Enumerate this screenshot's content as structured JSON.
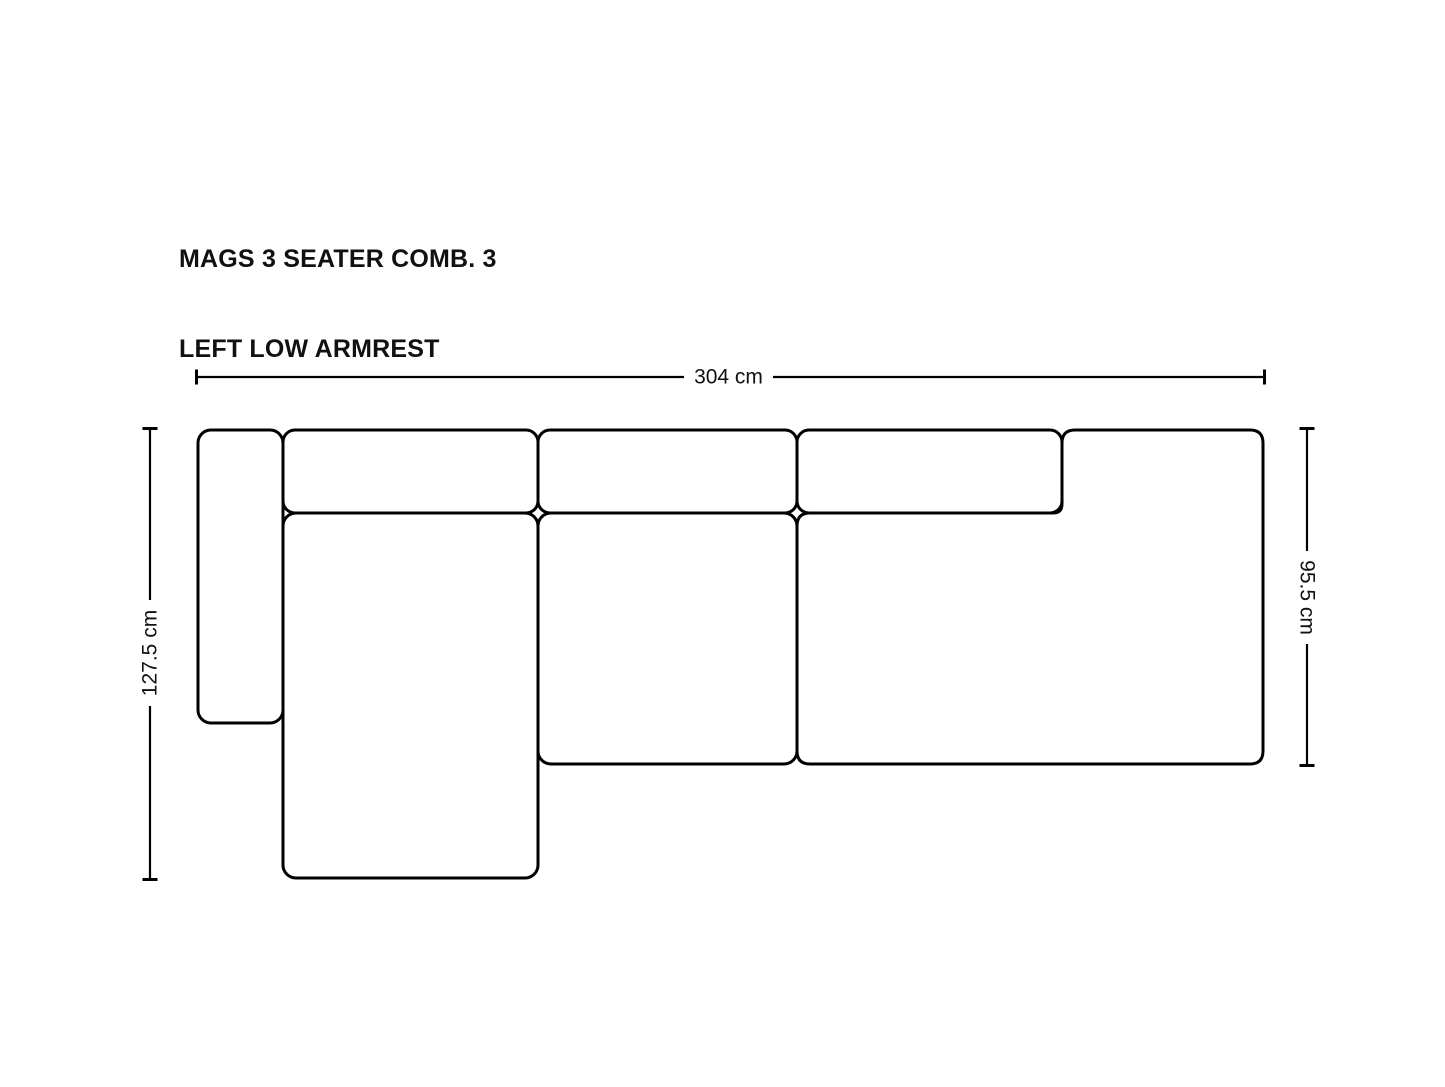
{
  "title": {
    "line1": "MAGS 3 SEATER COMB. 3",
    "line2": "LEFT LOW ARMREST"
  },
  "dimensions": {
    "width_label": "304 cm",
    "total_depth_label": "127.5 cm",
    "body_depth_label": "95.5 cm"
  },
  "colors": {
    "background": "#ffffff",
    "line": "#000000",
    "text": "#111111"
  },
  "diagram": {
    "product": "sofa-top-view",
    "modules": [
      {
        "name": "left-low-armrest"
      },
      {
        "name": "chaise-longue-seat"
      },
      {
        "name": "middle-seat"
      },
      {
        "name": "right-seat-with-armrest"
      },
      {
        "name": "back-cushion-left"
      },
      {
        "name": "back-cushion-middle"
      },
      {
        "name": "back-cushion-right"
      }
    ]
  }
}
